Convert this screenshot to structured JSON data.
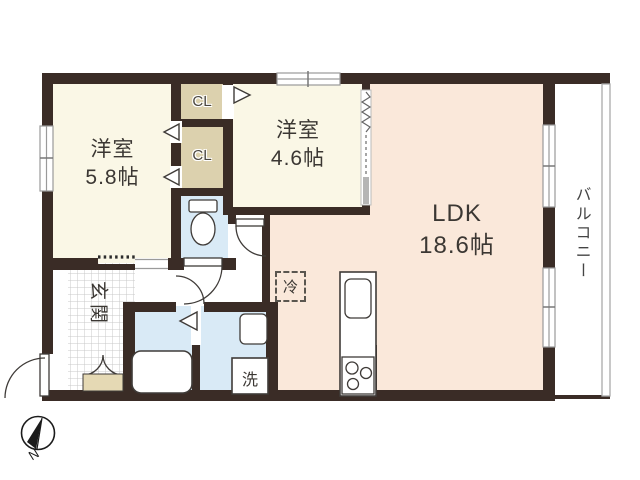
{
  "document_type": "apartment floor plan",
  "colors": {
    "wall": "#3a2c26",
    "cream": "#faf7e6",
    "tan": "#dcd1ae",
    "pink": "#fae8da",
    "blue": "#d9eaf6",
    "shoe_tan": "#e5d9b4",
    "window_gray": "#9a9a9a",
    "tile_line": "#c9c9c9",
    "text": "#3b3733"
  },
  "rooms": {
    "western_room_1": {
      "name": "洋室",
      "size": "5.8帖"
    },
    "western_room_2": {
      "name": "洋室",
      "size": "4.6帖"
    },
    "ldk": {
      "name": "LDK",
      "size": "18.6帖"
    },
    "closet_upper": {
      "label": "CL"
    },
    "closet_lower": {
      "label": "CL"
    },
    "entrance": {
      "label": "玄関"
    },
    "balcony": {
      "label": "バルコニー"
    }
  },
  "fixtures": {
    "refrigerator_label": "冷",
    "washing_machine_label": "洗"
  },
  "compass": {
    "north_label": "N"
  }
}
